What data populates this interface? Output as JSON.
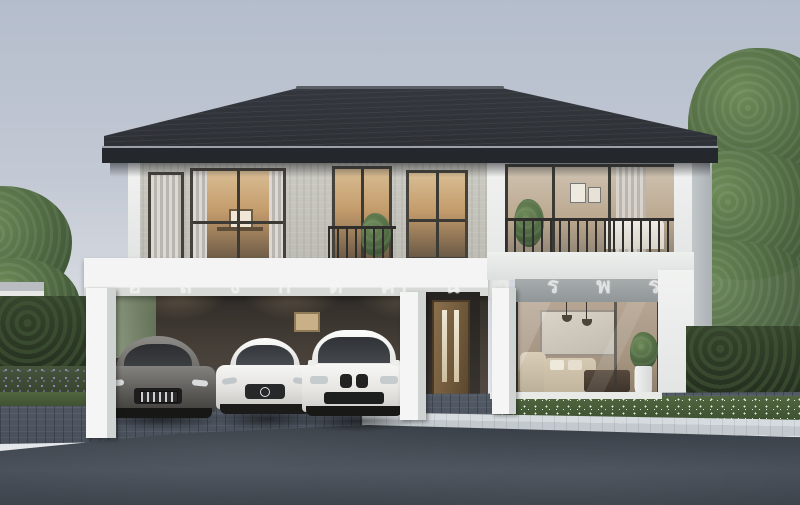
{
  "scene": {
    "title": "Modern two-storey house exterior render",
    "description": "Daytime architectural rendering of a two-storey modern detached house with dark hipped roof, stone-clad upper floor, carport sheltering three cars, glass-walled living room and landscaped driveway",
    "time_of_day": "day",
    "sky": {
      "top_color": "#b4bdcc",
      "bottom_color": "#e8eaec"
    }
  },
  "facade_text": {
    "note": "spaced Thai watermark lettering across the carport fascia and living-room transom",
    "letters": [
      "อ",
      "ล",
      "ง",
      "ก",
      "ต",
      "คำ",
      "น",
      "ว",
      "ร",
      "พ",
      "ร"
    ],
    "color": "#f2f4f2"
  },
  "house": {
    "roof_color": "#35393f",
    "fascia_color": "#24272b",
    "stone_wall_color": "#c4c3bb",
    "trim_color": "#f1f2f1",
    "window_frame_color": "#45423c",
    "warm_interior_glow": "#c49c6c",
    "front_door": {
      "material": "wood",
      "color": "#7d6344",
      "glass_slits": 2
    },
    "upper_floor_windows": 4,
    "balcony": {
      "railing_color": "#2f2e2c",
      "plant": true
    }
  },
  "carport": {
    "interior_color": "#463f38",
    "columns": 3,
    "downlights": 3,
    "wall_panel": {
      "color": "#c9b089"
    }
  },
  "cars": [
    {
      "position": "left",
      "type": "sports coupe",
      "color": "grey",
      "license_plate_visible": true,
      "license_plate_text": ""
    },
    {
      "position": "middle",
      "type": "sedan with round star badge",
      "color": "white"
    },
    {
      "position": "right",
      "type": "compact SUV with twin kidney grille",
      "color": "white"
    }
  ],
  "living_room": {
    "wall_finish": "marble",
    "artwork": true,
    "pendant_lamps": 2,
    "sofa_color": "#d6c9b2",
    "coffee_table_color": "#4a4038",
    "plant_in_white_pot": true
  },
  "landscaping": {
    "left_hedge": true,
    "right_hedge": true,
    "purple_flower_bed": "#8f8bbd",
    "white_flower_bed": "#e9ede6",
    "trees": [
      "large tree left edge",
      "large tree right edge"
    ]
  },
  "ground": {
    "driveway": "grey paver blocks",
    "road": "dark asphalt",
    "curb_color": "#ccd2d6"
  }
}
